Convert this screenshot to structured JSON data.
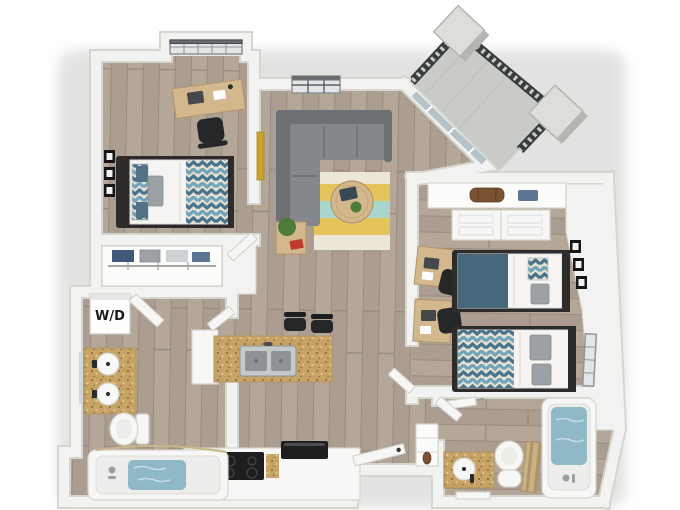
{
  "meta": {
    "description": "3D top-down floor plan rendering of a two-bedroom, two-bathroom apartment with an angled balcony",
    "canvas": {
      "width": 680,
      "height": 510
    }
  },
  "labels": {
    "washer_dryer": "W/D"
  },
  "rooms": [
    {
      "name": "bedroom-1",
      "items": [
        "window-alcove",
        "desk",
        "laptop",
        "office-chair",
        "twin-bed",
        "wall-art-frames",
        "reach-in-closet"
      ]
    },
    {
      "name": "living-room",
      "items": [
        "window",
        "sectional-sofa",
        "striped-area-rug",
        "round-coffee-table",
        "tablet",
        "potted-plant",
        "side-table",
        "framed-art"
      ]
    },
    {
      "name": "balcony",
      "items": [
        "metal-railing",
        "pillar",
        "pillar",
        "sliding-glass-door"
      ]
    },
    {
      "name": "bedroom-2",
      "items": [
        "closet-shelf",
        "duffel-bag",
        "sliding-closet-doors",
        "desk",
        "desk",
        "office-chair",
        "office-chair",
        "twin-bed",
        "twin-bed",
        "wall-art-frames",
        "window"
      ]
    },
    {
      "name": "kitchen",
      "items": [
        "island",
        "double-sink",
        "bar-stool",
        "bar-stool",
        "cooktop",
        "microwave",
        "counter"
      ]
    },
    {
      "name": "bathroom-1",
      "items": [
        "double-vanity",
        "sink",
        "sink",
        "mirror",
        "toilet",
        "bathtub"
      ]
    },
    {
      "name": "bathroom-2",
      "items": [
        "vanity",
        "sink",
        "toilet",
        "shower-curtain",
        "bathtub",
        "towel-bar",
        "bath-mat"
      ]
    },
    {
      "name": "laundry-closet",
      "items": [
        "washer-dryer"
      ]
    },
    {
      "name": "entry",
      "items": [
        "front-door",
        "linen-closet"
      ]
    }
  ],
  "colors": {
    "wall": "#f2f2f0",
    "wall_edge": "#d6d6d1",
    "floor_plank_a": "#b5a798",
    "floor_plank_b": "#ab9d8f",
    "floor_plank_line": "#988c7f",
    "balcony_floor": "#c9cbc7",
    "pillar_light": "#dcded9",
    "pillar_dark": "#b4b6b1",
    "railing": "#393c3e",
    "glass": "#b5c2c6",
    "sofa_dark": "#6d7073",
    "sofa_mid": "#84878b",
    "rug_cream": "#ece7d7",
    "rug_yellow": "#e5c45c",
    "rug_teal": "#a8d6cc",
    "wood": "#d2b88c",
    "wood_dark": "#b3946a",
    "counter": "#c7a466",
    "counter_fleck_dark": "#876636",
    "counter_fleck_light": "#ead8a6",
    "bed_frame": "#2d2c2b",
    "pillow_gray": "#9ba1a5",
    "pillow_steel": "#54718a",
    "blanket_teal": "#47687b",
    "chevron_bg": "#e7e1d3",
    "chevron_light": "#72a5ba",
    "chevron_dark": "#49758c",
    "fixture_white": "#f7f7f5",
    "fixture_edge": "#d4d4cf",
    "water": "#8fb9c6",
    "water_deep": "#76a5b4",
    "appliance_black": "#1d1e1f",
    "steel": "#c6c9cb",
    "steel_dark": "#8e9396",
    "chair_black": "#242628",
    "plant_green": "#4d7c3a",
    "book_red": "#c0392b",
    "gold": "#c9a227",
    "denim": "#3f5a78",
    "denim_light": "#5b7692",
    "duffel_brown": "#7a5232",
    "curtain_tan": "#c8b183",
    "curtain_tan_dark": "#ae9468",
    "closet_white": "#fbfbf9",
    "window_fill": "#e2e6e6",
    "window_frame": "#8f9496",
    "window_frame_dark": "#45484b",
    "mirror": "#cfd8db",
    "label": "#1a1a1a",
    "shadow": "#c7c7c4"
  }
}
